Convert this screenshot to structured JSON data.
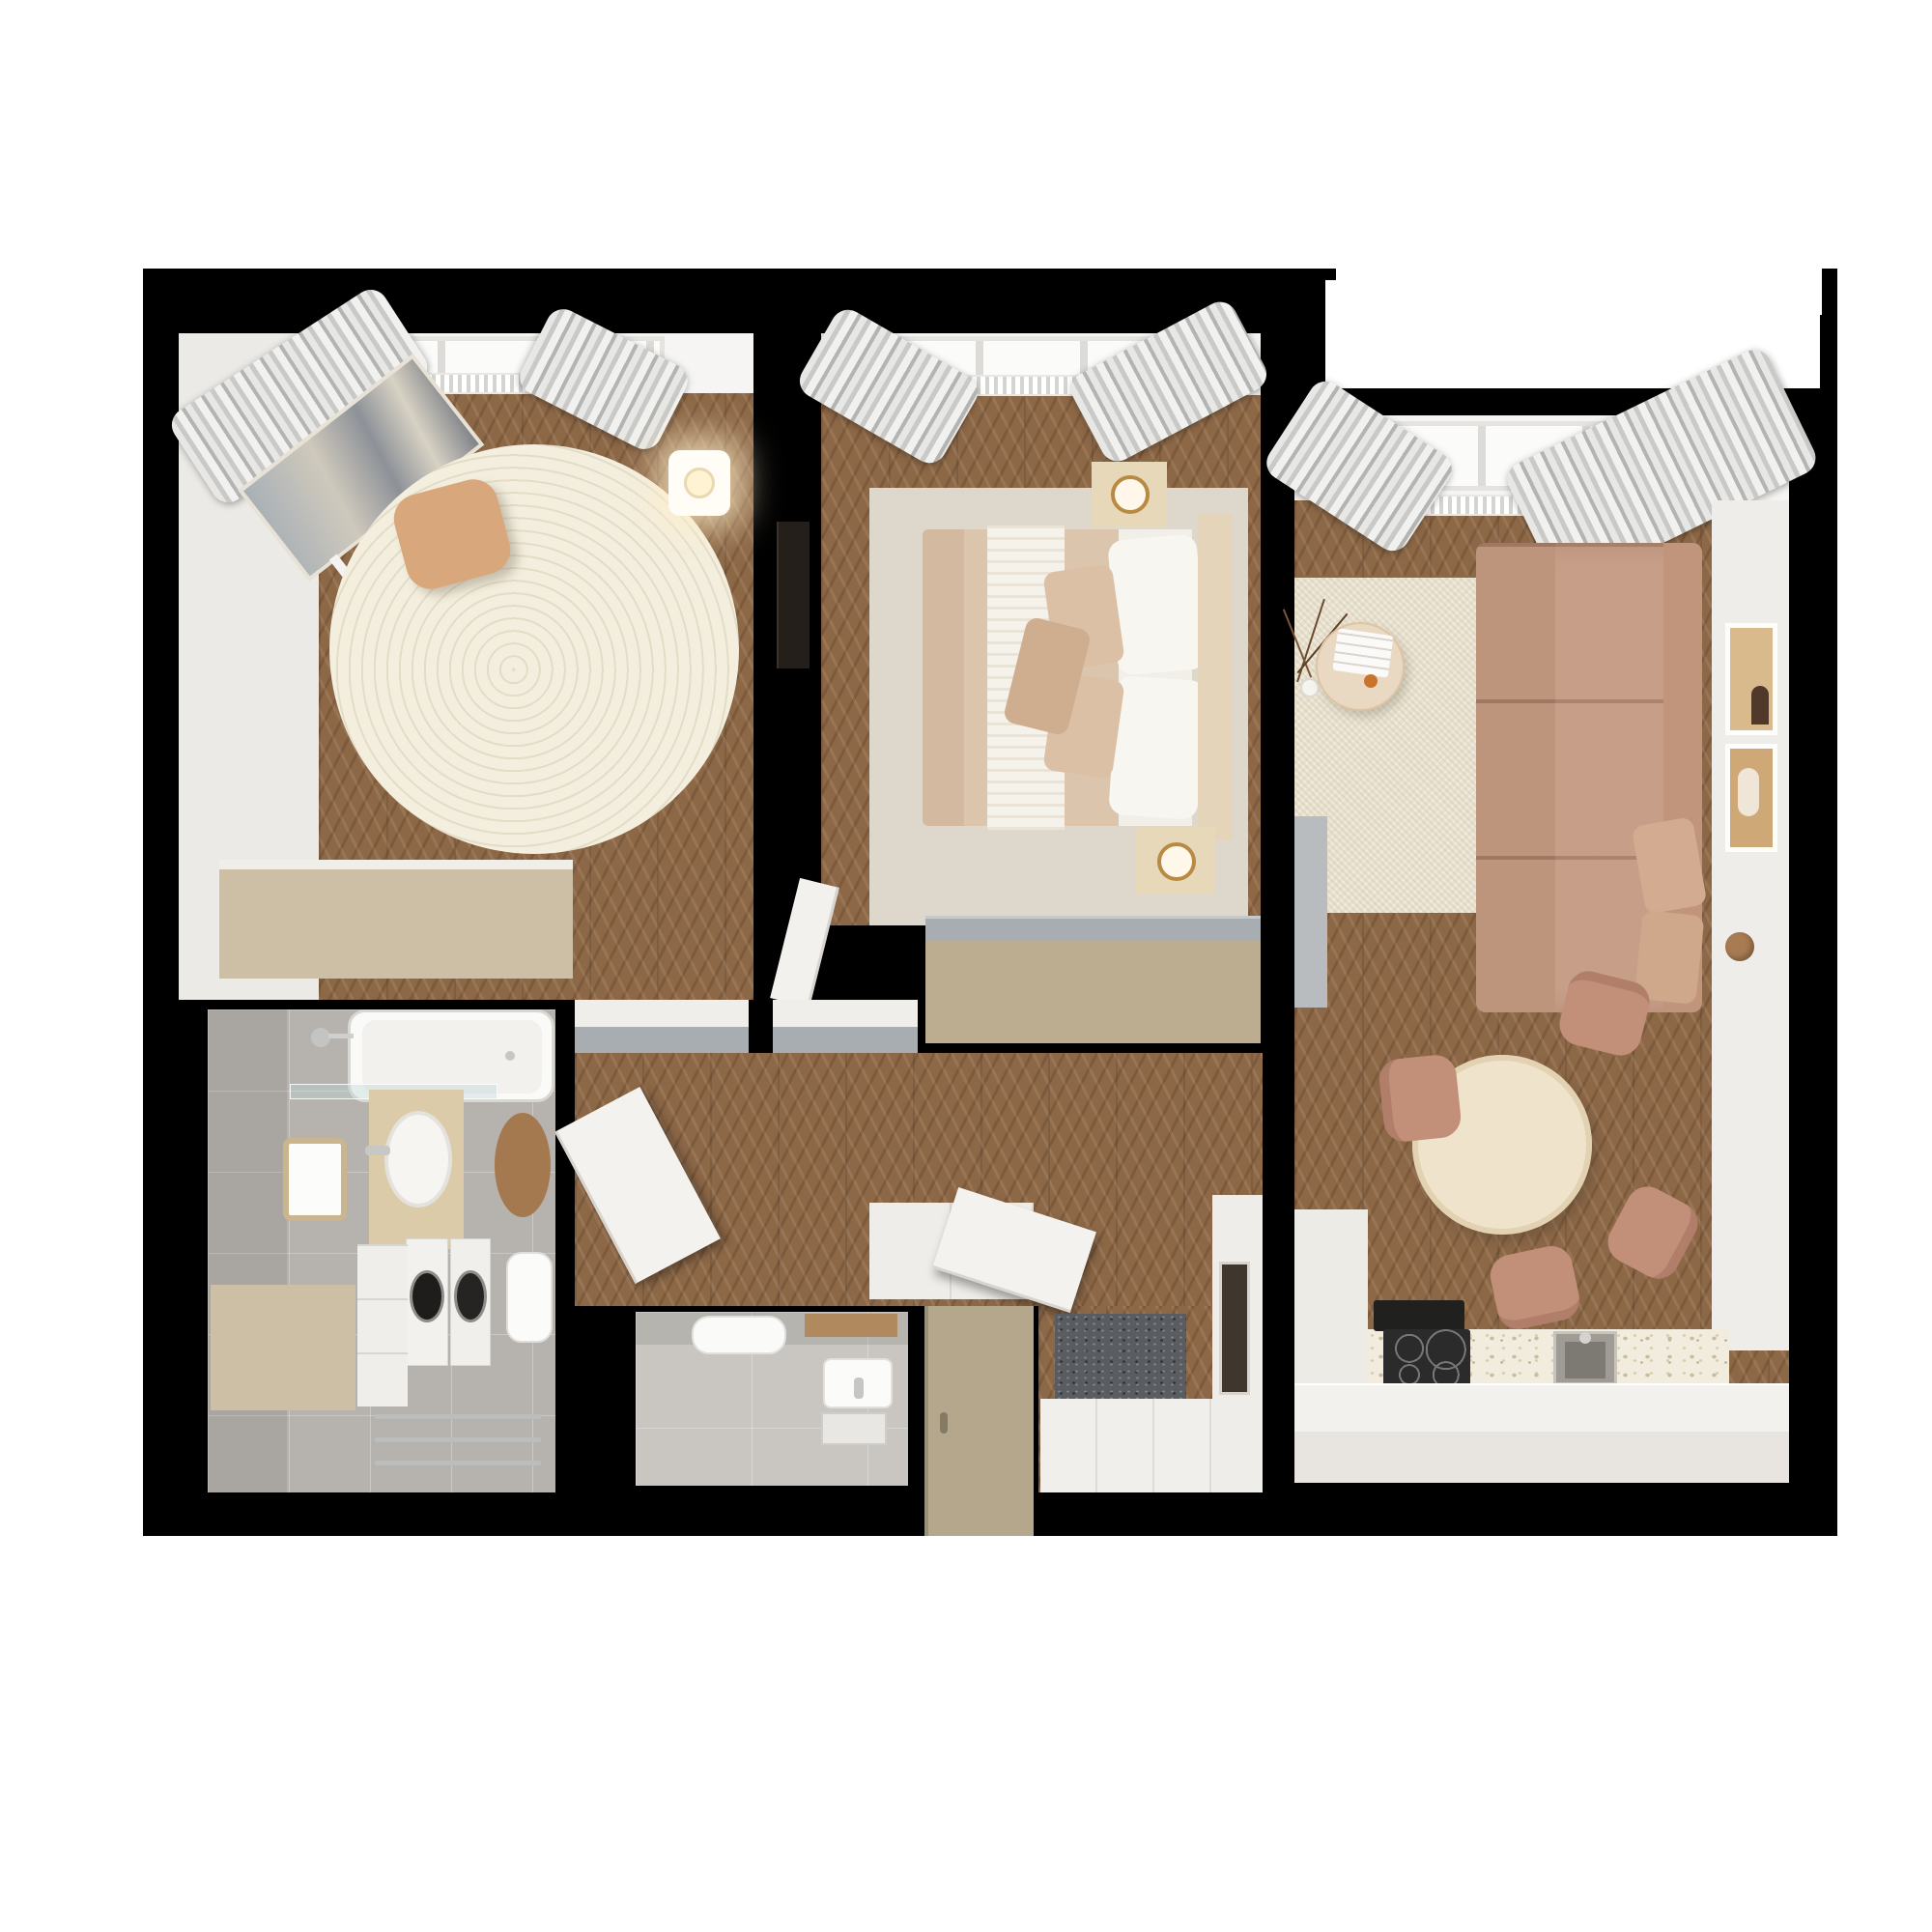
{
  "meta": {
    "type": "3d-apartment-floor-plan-top-view-render",
    "view": "top-down",
    "text_visible": "none"
  },
  "palette": {
    "bg_page": "#ffffff",
    "render_bg": "#000000",
    "wall_white": "#f1efec",
    "wall_face": "#e9e7e3",
    "wood": "#8d6847",
    "tile": "#b6b3ae",
    "tile_light": "#c9c6c1",
    "beige_cabinet": "#cdbfa5",
    "khaki_wardrobe": "#bcad90",
    "bed_beige": "#dbc5ad",
    "sofa": "#c79e87",
    "chair": "#c28f79",
    "cream_rug": "#f3eede",
    "shag_rug": "#e9e2d0",
    "gray_track": "#a7adb1",
    "door_tan": "#b5a78c",
    "mat": "#595c60",
    "terrazzo": "#f1ecdd",
    "chrome": "#c4c4c2",
    "appliance_dark": "#2b2b2b",
    "lamp_gold": "#b98a43"
  },
  "scene": {
    "rooms": [
      {
        "id": "studio-room",
        "position": "top-left",
        "furniture": [
          "window",
          "curtains",
          "radiator",
          "easel-with-painting",
          "round-rug",
          "stool",
          "floor-lamp",
          "beige-wardrobe"
        ]
      },
      {
        "id": "bedroom",
        "position": "top-center",
        "furniture": [
          "window",
          "curtains",
          "radiator",
          "double-bed",
          "pillows",
          "headboard",
          "nightstand-lamp-top",
          "nightstand-lamp-bottom",
          "wall-tv",
          "rug",
          "sliding-wardrobe",
          "open-door"
        ]
      },
      {
        "id": "living-room-kitchen",
        "position": "right",
        "furniture": [
          "window",
          "curtains",
          "radiator",
          "corner-sofa",
          "sofa-cushions",
          "coffee-table",
          "branch-decor",
          "shag-rug",
          "tv-panel",
          "wall-art-top",
          "wall-art-bottom",
          "wall-sconce",
          "dining-table",
          "dining-chairs-4",
          "kitchen-counter",
          "induction-hob",
          "cooker-hood",
          "kitchen-sink",
          "terrazzo-backsplash",
          "tall-cabinet"
        ]
      },
      {
        "id": "bathroom",
        "position": "bottom-left",
        "furniture": [
          "bathtub",
          "shower-set",
          "glass-shelf",
          "vanity-sink",
          "framed-mirror",
          "washing-machine",
          "dryer",
          "beige-countertop",
          "drawer-unit",
          "round-brown-rug",
          "toilet",
          "towel-ladder"
        ]
      },
      {
        "id": "hallway",
        "position": "center",
        "furniture": [
          "open-door-left",
          "open-door-right",
          "storage-closet",
          "sliding-door-tracks"
        ]
      },
      {
        "id": "wc",
        "position": "bottom-center",
        "furniture": [
          "wall-hung-toilet",
          "small-sink",
          "mirror",
          "wood-shelf"
        ]
      },
      {
        "id": "entry",
        "position": "bottom-center-right",
        "furniture": [
          "entrance-door",
          "doormat",
          "shoe-console",
          "wall-mirror"
        ]
      }
    ]
  }
}
